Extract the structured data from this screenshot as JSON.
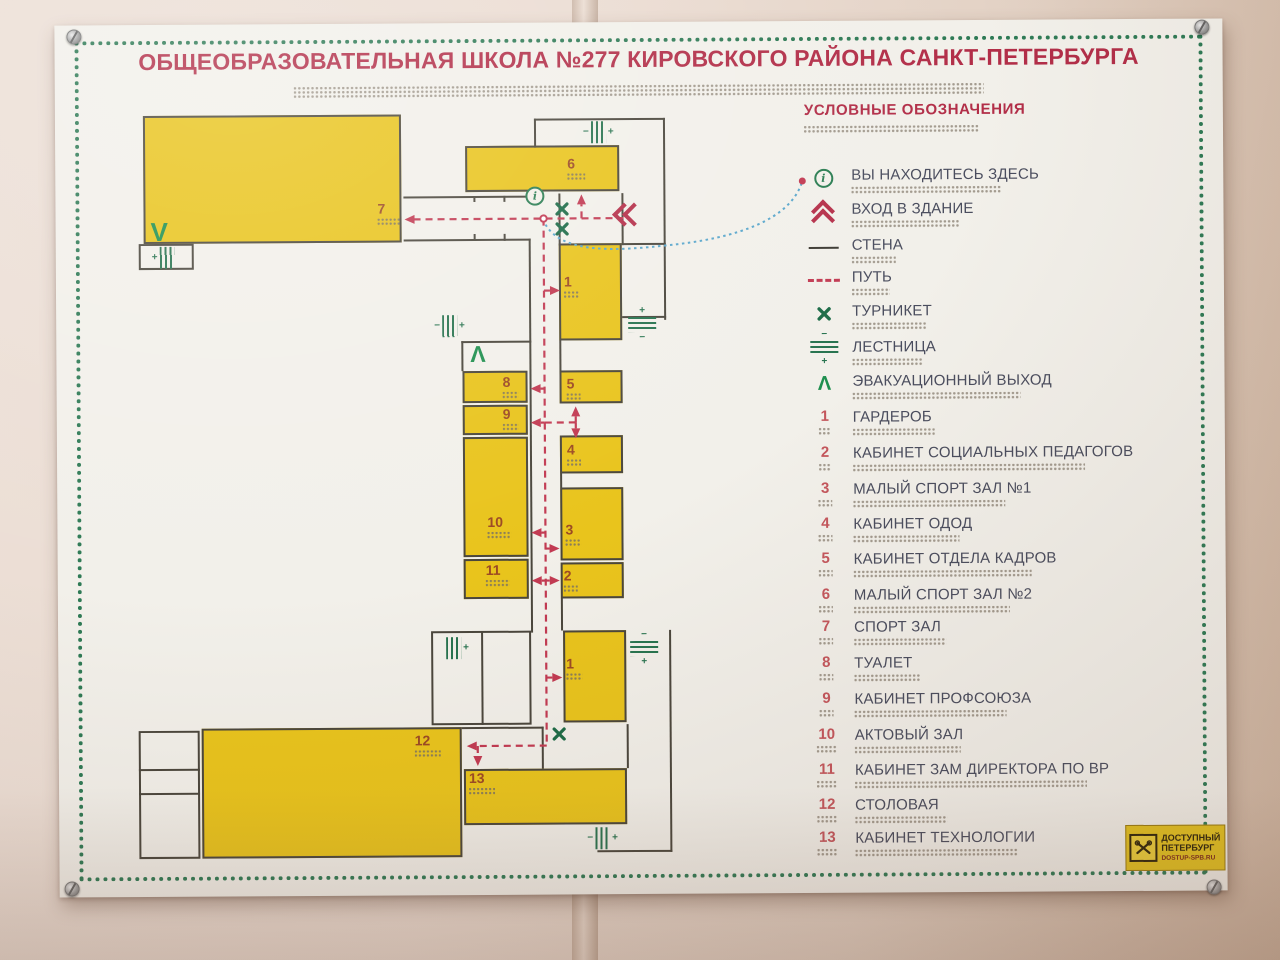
{
  "sign": {
    "title": "ОБЩЕОБРАЗОВАТЕЛЬНАЯ ШКОЛА №277 КИРОВСКОГО РАЙОНА САНКТ-ПЕТЕРБУРГА"
  },
  "legend": {
    "title": "УСЛОВНЫЕ ОБОЗНАЧЕНИЯ",
    "symbols": [
      {
        "icon": "you-are-here-icon",
        "label": "ВЫ НАХОДИТЕСЬ ЗДЕСЬ"
      },
      {
        "icon": "building-entrance-icon",
        "label": "ВХОД В ЗДАНИЕ"
      },
      {
        "icon": "wall-icon",
        "label": "СТЕНА"
      },
      {
        "icon": "path-icon",
        "label": "ПУТЬ"
      },
      {
        "icon": "turnstile-icon",
        "label": "ТУРНИКЕТ"
      },
      {
        "icon": "stairs-icon",
        "label": "ЛЕСТНИЦА"
      },
      {
        "icon": "evacuation-exit-icon",
        "label": "ЭВАКУАЦИОННЫЙ ВЫХОД"
      }
    ],
    "rooms": [
      {
        "number": "1",
        "label": "ГАРДЕРОБ"
      },
      {
        "number": "2",
        "label": "КАБИНЕТ СОЦИАЛЬНЫХ ПЕДАГОГОВ"
      },
      {
        "number": "3",
        "label": "МАЛЫЙ СПОРТ ЗАЛ №1"
      },
      {
        "number": "4",
        "label": "КАБИНЕТ ОДОД"
      },
      {
        "number": "5",
        "label": "КАБИНЕТ ОТДЕЛА КАДРОВ"
      },
      {
        "number": "6",
        "label": "МАЛЫЙ СПОРТ ЗАЛ №2"
      },
      {
        "number": "7",
        "label": "СПОРТ ЗАЛ"
      },
      {
        "number": "8",
        "label": "ТУАЛЕТ"
      },
      {
        "number": "9",
        "label": "КАБИНЕТ ПРОФСОЮЗА"
      },
      {
        "number": "10",
        "label": "АКТОВЫЙ ЗАЛ"
      },
      {
        "number": "11",
        "label": "КАБИНЕТ ЗАМ ДИРЕКТОРА ПО ВР"
      },
      {
        "number": "12",
        "label": "СТОЛОВАЯ"
      },
      {
        "number": "13",
        "label": "КАБИНЕТ ТЕХНОЛОГИИ"
      }
    ]
  },
  "plan": {
    "numbers": [
      "7",
      "6",
      "1",
      "5",
      "4",
      "8",
      "9",
      "10",
      "3",
      "11",
      "2",
      "1",
      "12",
      "13"
    ],
    "stairs_plus": "+",
    "stairs_minus": "−",
    "info_glyph": "i",
    "evac_up_glyph": "Λ",
    "evac_down_glyph": "V"
  },
  "logo": {
    "line1": "ДОСТУПНЫЙ",
    "line2": "ПЕТЕРБУРГ",
    "line3": "DOSTUP-SPB.RU"
  },
  "colors": {
    "accent_red": "#b22e48",
    "path_red": "#c23a52",
    "room_yellow": "#e9c41c",
    "icon_green": "#27734f",
    "evac_green": "#1e8f4e",
    "border_green": "#2e7a55",
    "text_dark": "#4a4d5e",
    "wall_dark": "#4a463c",
    "connector_blue": "#5aa7cc"
  }
}
